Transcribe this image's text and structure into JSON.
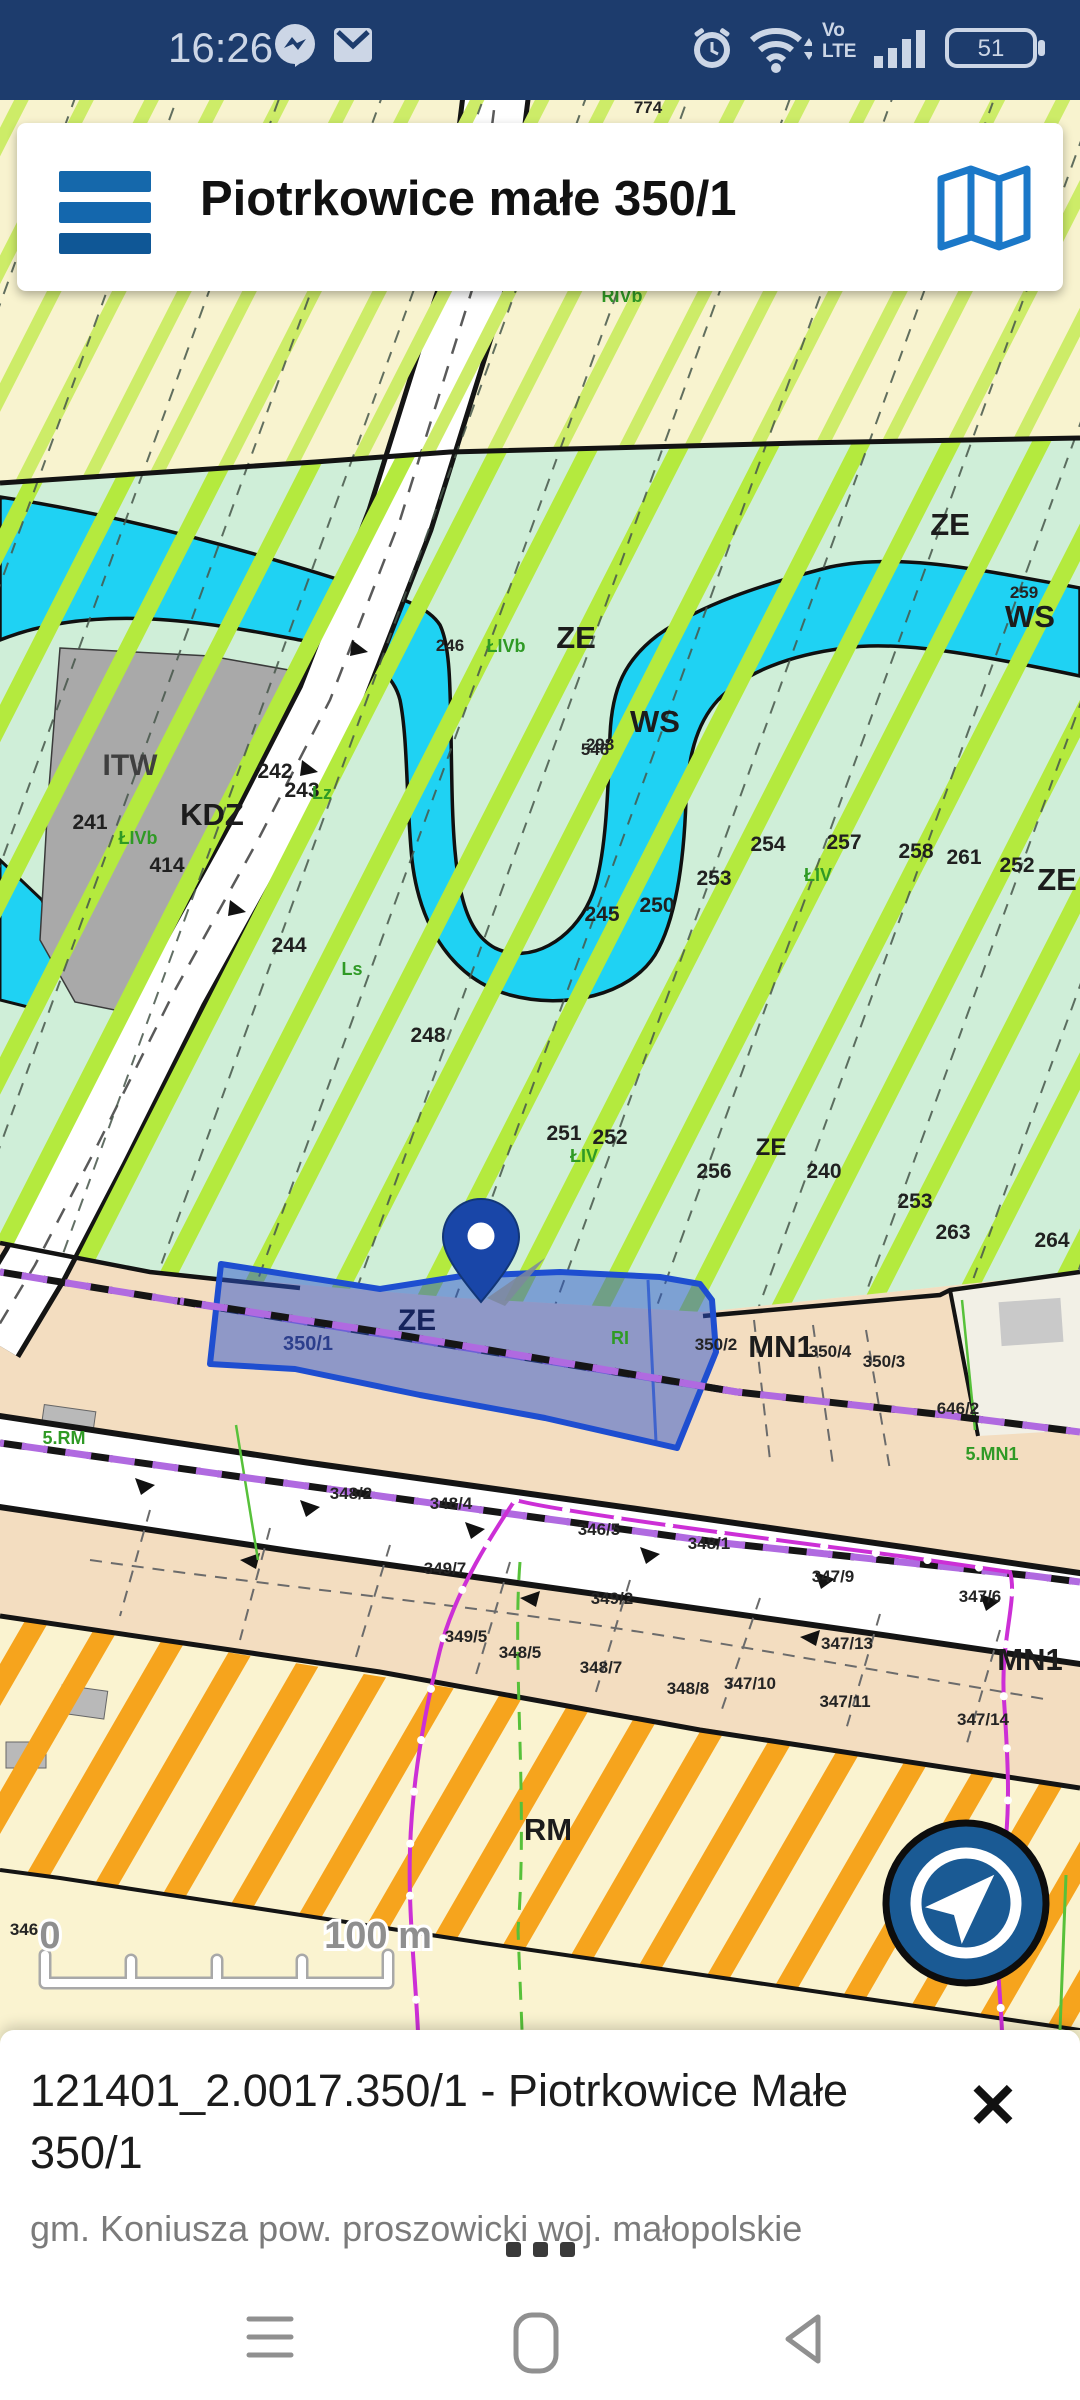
{
  "status_bar": {
    "time": "16:26",
    "battery": "51",
    "volte_line1": "Vo",
    "volte_line2": "LTE"
  },
  "header": {
    "title": "Piotrkowice małe 350/1"
  },
  "map": {
    "scale": {
      "zero": "0",
      "hundred": "100 m"
    },
    "colors": {
      "cream": "#f8f3cf",
      "mint": "#cfeed8",
      "peach": "#f3ddc0",
      "water": "#1fd2f3",
      "lime": "#b4ea3e",
      "orange_hatch": "#f6a41d",
      "selection_fill": "#2b54cd",
      "selection_stroke": "#1e4ed0",
      "pin_blue": "#1946a8",
      "compass_blue": "#1a5a94",
      "pipeline_magenta": "#cc2fd6"
    },
    "labels": [
      {
        "t": "774",
        "x": 648,
        "y": 113,
        "k": "s"
      },
      {
        "t": "ZE",
        "x": 576,
        "y": 648,
        "k": "z"
      },
      {
        "t": "ZE",
        "x": 950,
        "y": 535,
        "k": "z"
      },
      {
        "t": "ZE",
        "x": 1057,
        "y": 890,
        "k": "z"
      },
      {
        "t": "ZE",
        "x": 771,
        "y": 1155,
        "k": "zs"
      },
      {
        "t": "ZE",
        "x": 417,
        "y": 1330,
        "k": "zp"
      },
      {
        "t": "WS",
        "x": 655,
        "y": 732,
        "k": "z"
      },
      {
        "t": "WS",
        "x": 1030,
        "y": 627,
        "k": "z"
      },
      {
        "t": "ITW",
        "x": 130,
        "y": 775,
        "k": "zg"
      },
      {
        "t": "KDZ",
        "x": 212,
        "y": 825,
        "k": "z"
      },
      {
        "t": "MN1",
        "x": 781,
        "y": 1357,
        "k": "z"
      },
      {
        "t": "MN1",
        "x": 1030,
        "y": 1670,
        "k": "z"
      },
      {
        "t": "RM",
        "x": 548,
        "y": 1840,
        "k": "z"
      },
      {
        "t": "259",
        "x": 1024,
        "y": 598,
        "k": "s"
      },
      {
        "t": "246",
        "x": 450,
        "y": 651,
        "k": "s"
      },
      {
        "t": "298",
        "x": 600,
        "y": 750,
        "k": "s"
      },
      {
        "t": "546",
        "x": 595,
        "y": 755,
        "k": "s"
      },
      {
        "t": "254",
        "x": 768,
        "y": 851,
        "k": "n"
      },
      {
        "t": "257",
        "x": 844,
        "y": 849,
        "k": "n"
      },
      {
        "t": "258",
        "x": 916,
        "y": 858,
        "k": "n"
      },
      {
        "t": "261",
        "x": 964,
        "y": 864,
        "k": "n"
      },
      {
        "t": "252",
        "x": 1017,
        "y": 872,
        "k": "n"
      },
      {
        "t": "253",
        "x": 714,
        "y": 885,
        "k": "n"
      },
      {
        "t": "250",
        "x": 657,
        "y": 912,
        "k": "n"
      },
      {
        "t": "245",
        "x": 602,
        "y": 921,
        "k": "n"
      },
      {
        "t": "244",
        "x": 289,
        "y": 952,
        "k": "n"
      },
      {
        "t": "248",
        "x": 428,
        "y": 1042,
        "k": "n"
      },
      {
        "t": "241",
        "x": 90,
        "y": 829,
        "k": "n"
      },
      {
        "t": "242",
        "x": 275,
        "y": 778,
        "k": "n"
      },
      {
        "t": "243",
        "x": 302,
        "y": 797,
        "k": "n"
      },
      {
        "t": "414",
        "x": 167,
        "y": 872,
        "k": "n"
      },
      {
        "t": "251",
        "x": 564,
        "y": 1140,
        "k": "n"
      },
      {
        "t": "252",
        "x": 610,
        "y": 1144,
        "k": "n"
      },
      {
        "t": "256",
        "x": 714,
        "y": 1178,
        "k": "n"
      },
      {
        "t": "240",
        "x": 824,
        "y": 1178,
        "k": "n"
      },
      {
        "t": "253",
        "x": 915,
        "y": 1208,
        "k": "n"
      },
      {
        "t": "263",
        "x": 953,
        "y": 1239,
        "k": "n"
      },
      {
        "t": "264",
        "x": 1052,
        "y": 1247,
        "k": "n"
      },
      {
        "t": "346",
        "x": 24,
        "y": 1935,
        "k": "s"
      },
      {
        "t": "350/1",
        "x": 308,
        "y": 1350,
        "k": "b"
      },
      {
        "t": "350/2",
        "x": 716,
        "y": 1350,
        "k": "s"
      },
      {
        "t": "350/4",
        "x": 830,
        "y": 1357,
        "k": "s"
      },
      {
        "t": "350/3",
        "x": 884,
        "y": 1367,
        "k": "s"
      },
      {
        "t": "646/2",
        "x": 958,
        "y": 1414,
        "k": "s"
      },
      {
        "t": "348/2",
        "x": 351,
        "y": 1499,
        "k": "s"
      },
      {
        "t": "348/4",
        "x": 451,
        "y": 1509,
        "k": "s"
      },
      {
        "t": "346/5",
        "x": 599,
        "y": 1535,
        "k": "s"
      },
      {
        "t": "348/1",
        "x": 709,
        "y": 1549,
        "k": "s"
      },
      {
        "t": "347/9",
        "x": 833,
        "y": 1582,
        "k": "s"
      },
      {
        "t": "347/6",
        "x": 980,
        "y": 1602,
        "k": "s"
      },
      {
        "t": "349/7",
        "x": 445,
        "y": 1574,
        "k": "s"
      },
      {
        "t": "349/2",
        "x": 612,
        "y": 1604,
        "k": "s"
      },
      {
        "t": "349/5",
        "x": 466,
        "y": 1642,
        "k": "s"
      },
      {
        "t": "348/5",
        "x": 520,
        "y": 1658,
        "k": "s"
      },
      {
        "t": "348/7",
        "x": 601,
        "y": 1673,
        "k": "s"
      },
      {
        "t": "348/8",
        "x": 688,
        "y": 1694,
        "k": "s"
      },
      {
        "t": "347/10",
        "x": 750,
        "y": 1689,
        "k": "s"
      },
      {
        "t": "347/13",
        "x": 847,
        "y": 1649,
        "k": "s"
      },
      {
        "t": "347/11",
        "x": 845,
        "y": 1707,
        "k": "s"
      },
      {
        "t": "347/14",
        "x": 983,
        "y": 1725,
        "k": "s"
      },
      {
        "t": "RIVb",
        "x": 622,
        "y": 302,
        "k": "g"
      },
      {
        "t": "ŁIVb",
        "x": 506,
        "y": 652,
        "k": "g"
      },
      {
        "t": "ŁIV",
        "x": 818,
        "y": 881,
        "k": "g"
      },
      {
        "t": "Ls",
        "x": 352,
        "y": 975,
        "k": "g"
      },
      {
        "t": "ŁIVb",
        "x": 138,
        "y": 844,
        "k": "g"
      },
      {
        "t": "Lz",
        "x": 322,
        "y": 799,
        "k": "g"
      },
      {
        "t": "ŁIV",
        "x": 584,
        "y": 1162,
        "k": "g"
      },
      {
        "t": "RI",
        "x": 620,
        "y": 1344,
        "k": "g"
      },
      {
        "t": "5.RM",
        "x": 64,
        "y": 1444,
        "k": "g"
      },
      {
        "t": "5.MN1",
        "x": 992,
        "y": 1460,
        "k": "g"
      }
    ]
  },
  "bottom_sheet": {
    "title": "121401_2.0017.350/1 - Piotrkowice Małe 350/1",
    "subtitle": "gm. Koniusza  pow. proszowicki woj. małopolskie"
  }
}
